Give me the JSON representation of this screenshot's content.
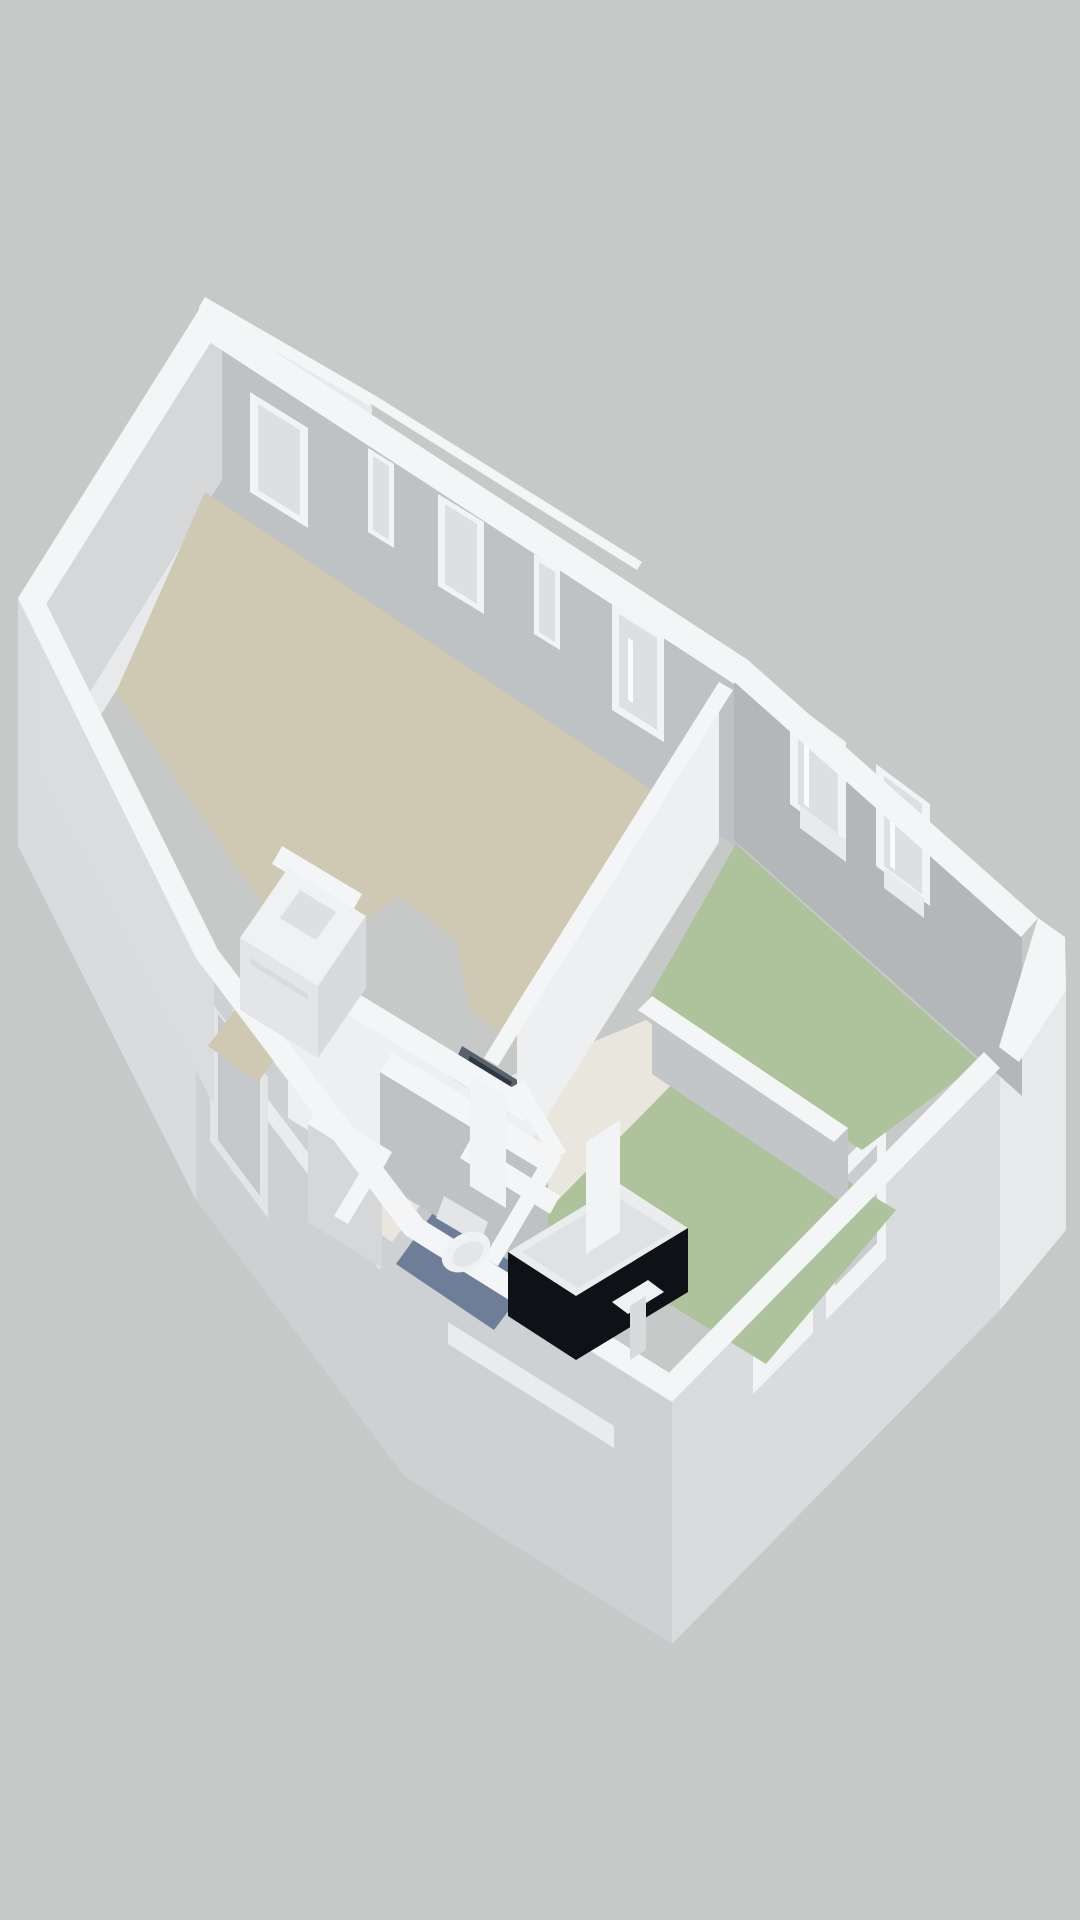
{
  "scene": {
    "title": "3D isometric floor plan rendering of an apartment",
    "view": "axonometric top-down, walls extruded, no text labels",
    "background_color": "#c7c8c8"
  },
  "palette": {
    "background": "#c7c8c8",
    "wallTop": "#f4f5f7",
    "extFace1": "#e7e9eb",
    "extFace2": "#d9dcde",
    "extFace3": "#ced1d4",
    "slitLight": "#e9ebed",
    "doorFrame": "#e2e4e6",
    "doorPanel": "#c5c8cb",
    "winFrame": "#f1f3f4",
    "glassLite": "#dde0e3",
    "glassGreen": "#c6d0ba",
    "glassGray": "#c9cdd0",
    "intFaceA": "#bfc2c5",
    "intFaceB": "#d5d7d9",
    "intFaceC": "#dadcdf",
    "intFaceD": "#b4b7ba",
    "intFaceE": "#edeff1",
    "intFaceC2": "#c3c6c9",
    "floorLiving": "#cfc8b3",
    "floorBedroom": "#aec29c",
    "floorBath": "#6e7e99",
    "floorHall": "#e9e7dd",
    "fixtureTop": "#eff1f3",
    "fixtureFace": "#e3e5e7",
    "fixtureFace2": "#d8dadd",
    "tubTop": "#eaecee",
    "tubInner": "#dfe2e4",
    "tubPanel": "#0e1216",
    "shaftDark": "#59616c",
    "shaftCore": "#2f3742",
    "doorLeaf": "#f2f3f5",
    "radiator": "#e8eaec",
    "handleWhite": "#fafbfc"
  },
  "rooms": [
    {
      "id": "living-room",
      "floor_color": "#cfc8b3",
      "floor_finish": "tan",
      "features": [
        "kitchen-unit",
        "north-wall-windows"
      ]
    },
    {
      "id": "bedroom-1",
      "floor_color": "#aec29c",
      "floor_finish": "green",
      "features": [
        "two-windows-northeast-wall",
        "glazed-door",
        "radiators"
      ]
    },
    {
      "id": "bedroom-2",
      "floor_color": "#aec29c",
      "floor_finish": "green",
      "features": [
        "two-windows-southeast-wall"
      ]
    },
    {
      "id": "bathroom",
      "floor_color": "#6e7e99",
      "floor_finish": "blue",
      "features": [
        "toilet",
        "bathtub-black-panel",
        "washbasin"
      ]
    },
    {
      "id": "hallway",
      "floor_color": "#e9e7dd",
      "floor_finish": "light",
      "features": [
        "duct-shaft",
        "interior-doors"
      ]
    },
    {
      "id": "entry",
      "floor_color": "#cfc8b3",
      "floor_finish": "tan",
      "features": [
        "entrance-door-exterior"
      ]
    }
  ],
  "fixtures": [
    "kitchen-unit",
    "toilet",
    "bathtub",
    "washbasin",
    "entrance-door",
    "interior-door-leaf"
  ],
  "openings": {
    "living_north_windows": 4,
    "bedroom1_glazed_doors": 1,
    "bedroom1_northeast_windows": 2,
    "bedroom2_southeast_windows": 2,
    "exterior_slit_windows": 3,
    "entrance_doors": 1
  }
}
